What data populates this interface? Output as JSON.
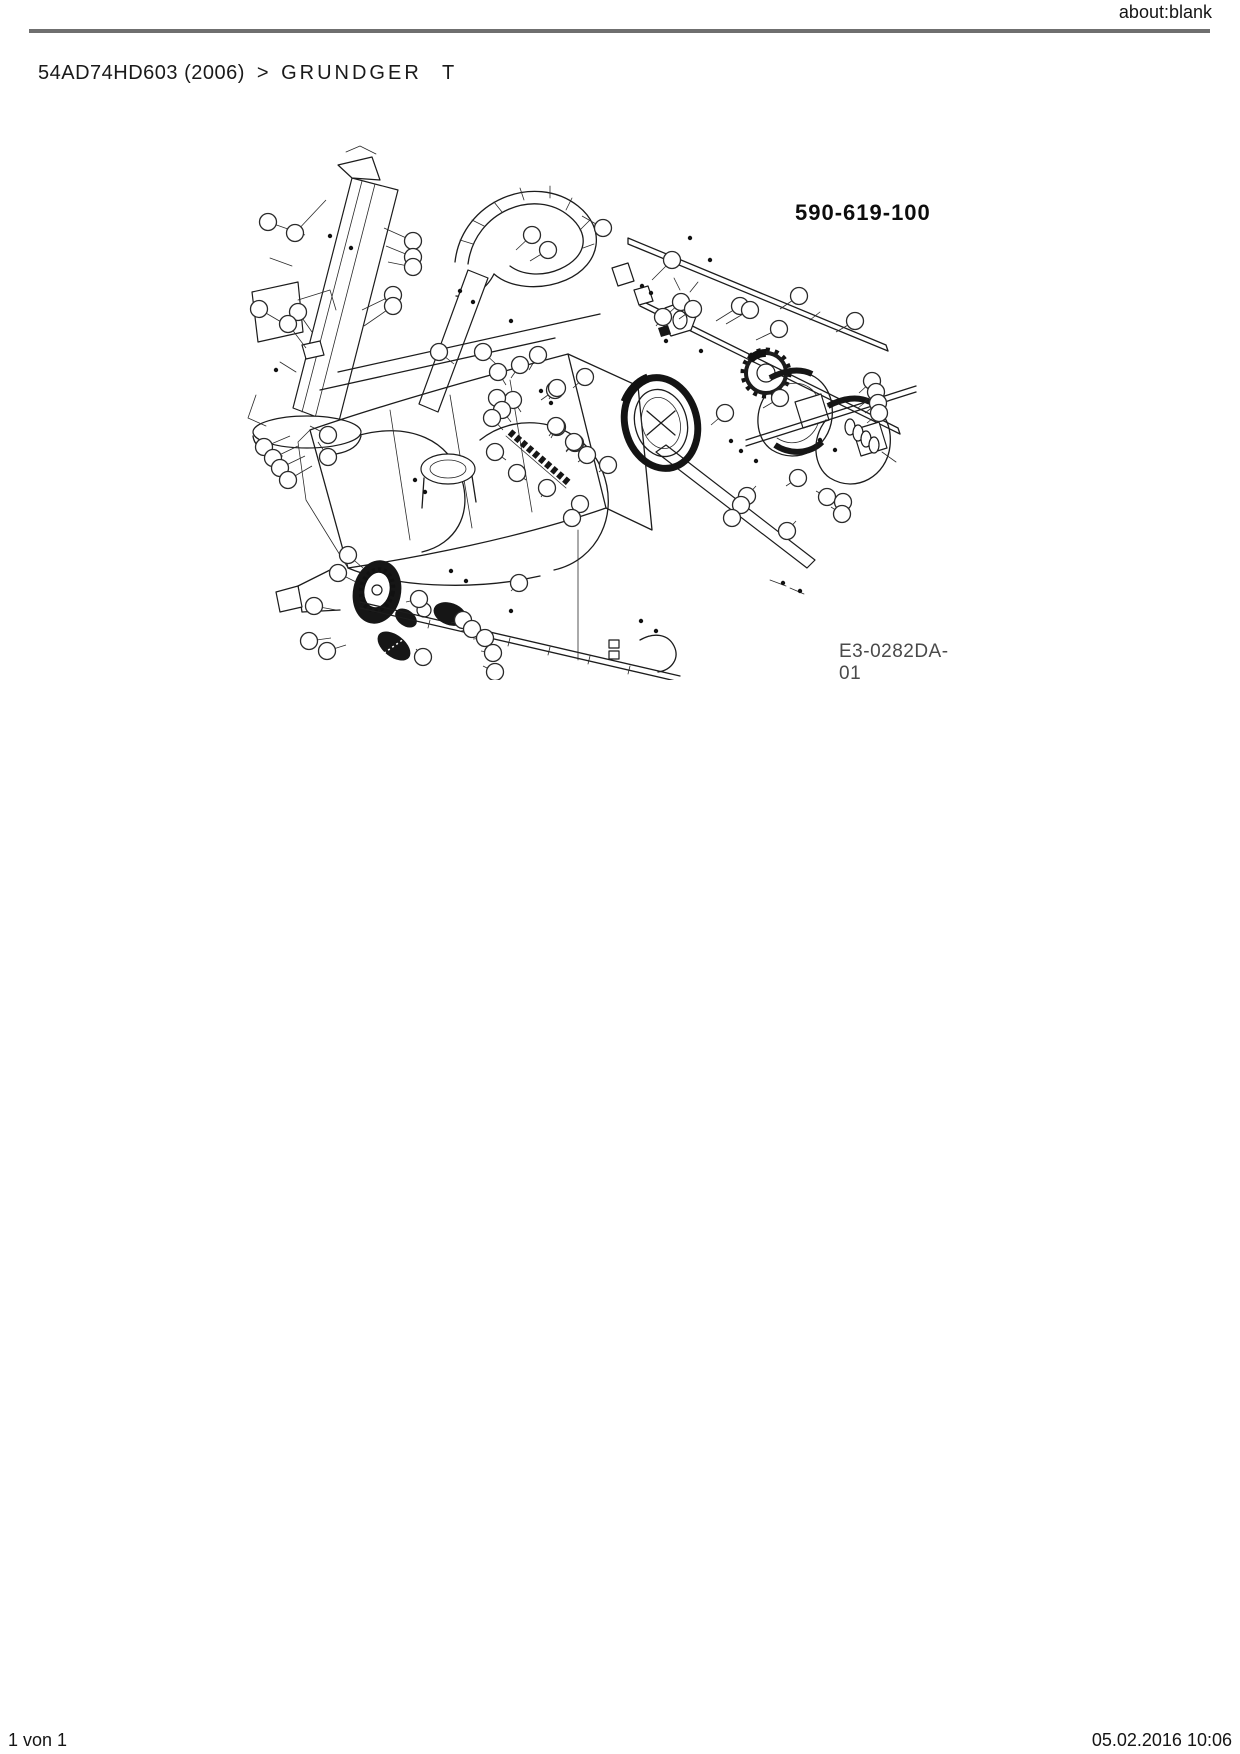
{
  "header": {
    "url_label": "about:blank",
    "rule_color": "#6f6f6f"
  },
  "breadcrumb": {
    "model": "54AD74HD603 (2006)",
    "separator": ">",
    "section": "GRUNDGER T"
  },
  "diagram": {
    "part_number": "590-619-100",
    "drawing_number": "E3-0282DA-01",
    "ink_color": "#1c1c1c",
    "description": "Exploded parts view of snow thrower base unit with numbered callout balloons"
  },
  "footer": {
    "page_info": "1 von 1",
    "timestamp": "05.02.2016 10:06"
  }
}
